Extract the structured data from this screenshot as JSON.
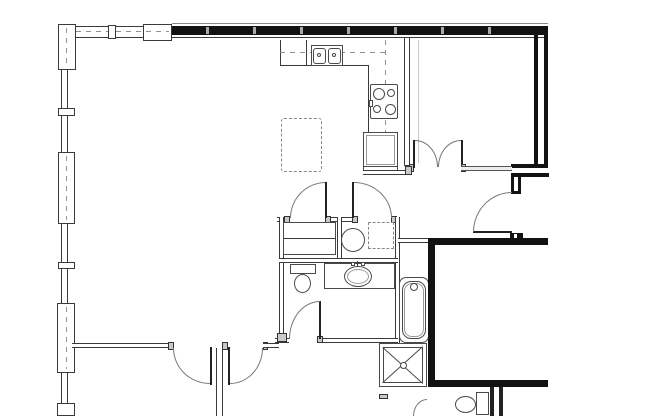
{
  "drawing": {
    "type": "architectural-floor-plan",
    "title": "Apartment unit floor plan (no text labels in drawing)",
    "rooms": [
      {
        "id": "living",
        "label": "Open living / dining area"
      },
      {
        "id": "kitchen",
        "label": "Kitchen with L-shaped counter and island"
      },
      {
        "id": "bedroom",
        "label": "Bedroom with double doors (top right)"
      },
      {
        "id": "bathroom",
        "label": "Bathroom with toilet, vanity and tub"
      },
      {
        "id": "closets",
        "label": "Linen closet and stacked washer/dryer closet"
      },
      {
        "id": "hall",
        "label": "Hallway with two swing doors (bottom)"
      },
      {
        "id": "shaft",
        "label": "Adjacent unit / stair void with thick walls (lower right)"
      }
    ],
    "fixtures": {
      "kitchen_sink": {
        "label": "Double-basin kitchen sink"
      },
      "cooktop": {
        "label": "4-burner cooktop / range"
      },
      "refrigerator": {
        "label": "Refrigerator"
      },
      "island": {
        "label": "Kitchen island (dashed outline)"
      },
      "upper_cabinets": {
        "label": "Upper cabinets (dashed line)"
      },
      "washer": {
        "label": "Washer (circle)"
      },
      "dryer": {
        "label": "Dryer (dashed square)"
      },
      "linen_shelf": {
        "label": "Linen closet shelving"
      },
      "toilet_main": {
        "label": "Toilet"
      },
      "vanity_sink": {
        "label": "Vanity with oval lavatory sink"
      },
      "bathtub": {
        "label": "Bathtub with faucet"
      },
      "shower_shaft": {
        "label": "Shower / chase marked with X"
      },
      "toilet_lower": {
        "label": "Toilet of lower unit (partially visible)"
      },
      "entry_door": {
        "label": "Unit entry door with swing arc"
      },
      "double_doors_bedroom": {
        "label": "Bedroom double doors"
      },
      "closet_doors": {
        "label": "Closet swing doors"
      },
      "hall_doors": {
        "label": "Hallway swing doors"
      },
      "windows": {
        "label": "Window wall with mullions and piers (left and top-left)"
      }
    },
    "colors": {
      "background": "#ffffff",
      "thick_wall": "#121212",
      "thin_wall": "#3a3a3a",
      "fixture_line": "#4a4a4a",
      "dashed_line": "#888888",
      "door_arc": "#777777"
    }
  }
}
